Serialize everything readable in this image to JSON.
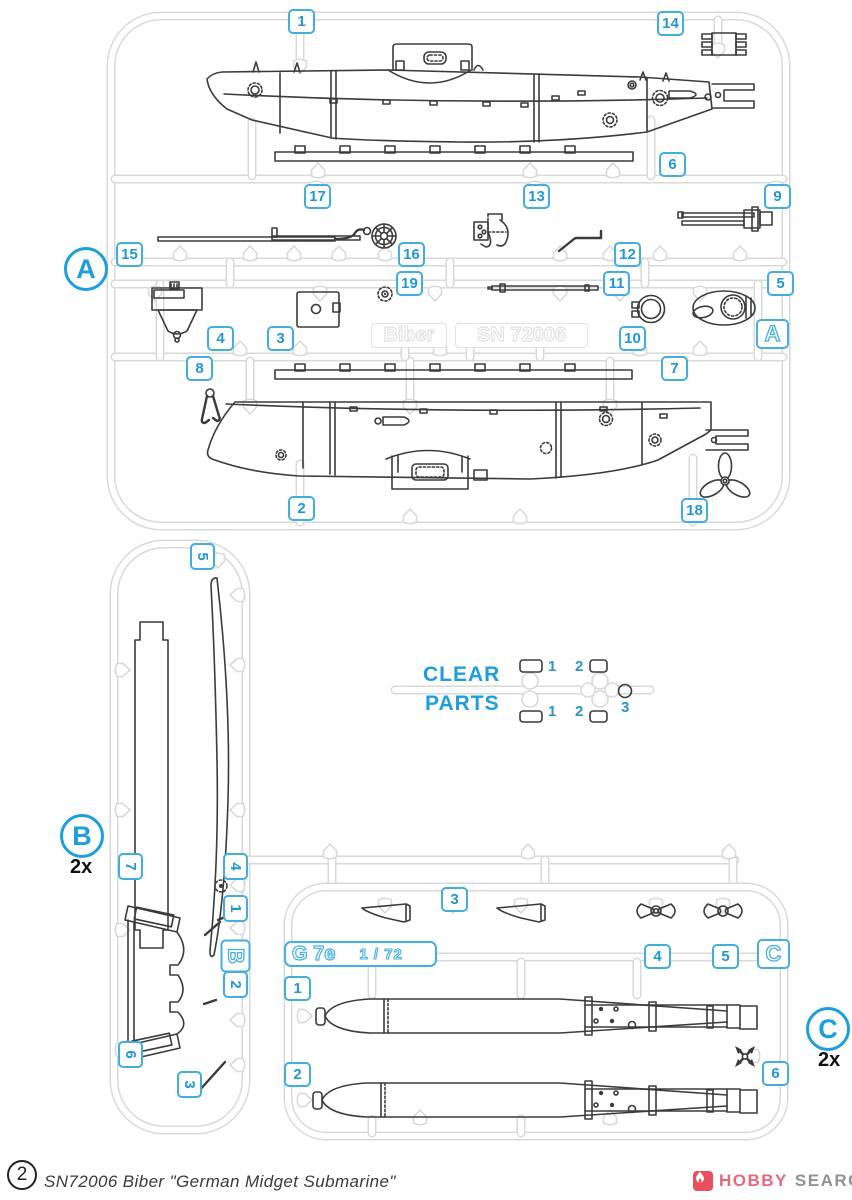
{
  "colors": {
    "accent_blue": "#2297d4",
    "sprue_gray": "#d9d9d9",
    "emboss_gray": "#e2e2e2",
    "part_line": "#3b3b3b",
    "logo_red": "#e8505f",
    "logo_pink": "#e4697b",
    "logo_gray": "#909295"
  },
  "sprue_a": {
    "badge": "A",
    "frame_letter": "A",
    "plate_left": "Biber",
    "plate_right": "SN 72006",
    "numbers": [
      "1",
      "2",
      "3",
      "4",
      "5",
      "6",
      "7",
      "8",
      "9",
      "10",
      "11",
      "12",
      "13",
      "14",
      "15",
      "16",
      "17",
      "18",
      "19"
    ]
  },
  "sprue_b": {
    "badge": "B",
    "multiplier": "2x",
    "frame_letter": "B",
    "numbers": [
      "1",
      "2",
      "3",
      "4",
      "5",
      "6",
      "7"
    ]
  },
  "sprue_c": {
    "badge": "C",
    "multiplier": "2x",
    "frame_letter": "C",
    "plate_title": "G 7e",
    "plate_scale": "1 / 72",
    "numbers": [
      "1",
      "2",
      "3",
      "4",
      "5",
      "6"
    ]
  },
  "clear_parts": {
    "title_line1": "CLEAR",
    "title_line2": "PARTS",
    "top_numbers": [
      "1",
      "2"
    ],
    "bottom_numbers": [
      "1",
      "2"
    ],
    "ring_number": "3"
  },
  "footer": {
    "sheet_number": "2",
    "kit_title": "SN72006 Biber \"German Midget Submarine\""
  },
  "logo": {
    "word1": "HOBBY",
    "word2": "SEARCH"
  }
}
